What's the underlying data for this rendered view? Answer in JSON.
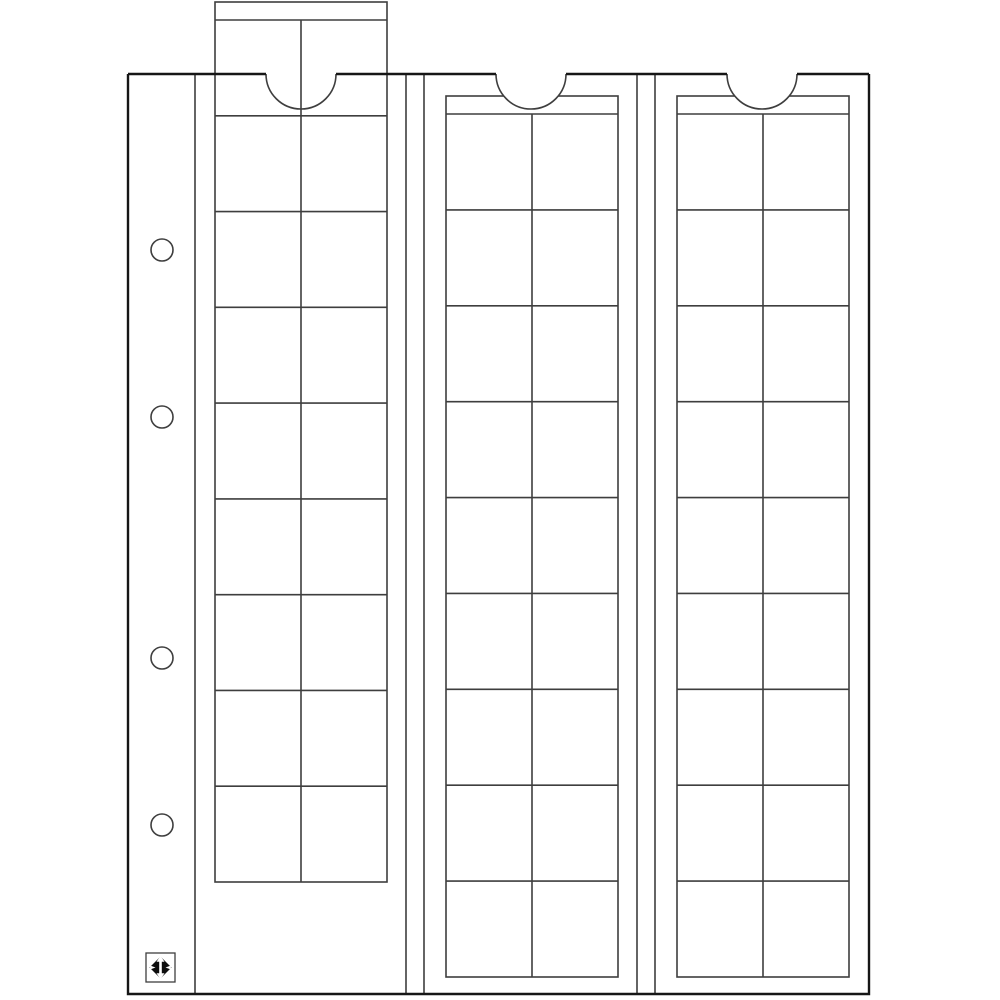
{
  "illustration": {
    "kind": "coin-album-pocket-sheet-line-drawing",
    "canvas": {
      "width": 1000,
      "height": 1000,
      "background": "#ffffff"
    },
    "style": {
      "fill": "#ffffff",
      "line_color": "#3e3e3e",
      "line_width": 1.6,
      "page_border_color": "#161616",
      "page_border_width": 2.4,
      "logo_black": "#0d0d0d",
      "logo_frame_width": 1.3
    },
    "page": {
      "left": 128,
      "top": 74,
      "right": 869,
      "bottom": 994
    },
    "binding_margin": {
      "divider_x": 195,
      "hole_count": 4,
      "holes": {
        "cx": 162,
        "r": 11,
        "cy_list": [
          250,
          417,
          658,
          825
        ]
      }
    },
    "slot_weld_lines_x": [
      406,
      424,
      637,
      655
    ],
    "thumb_notches": {
      "radius": 35,
      "centers_x": [
        301,
        531,
        762
      ]
    },
    "strips": [
      {
        "id": "strip-1",
        "left": 215,
        "top": 2,
        "right": 387,
        "bottom": 882,
        "header_line_y": 20,
        "center_x": 301,
        "rows": 9,
        "cols": 2,
        "pockets": 18,
        "pulled_out": true
      },
      {
        "id": "strip-2",
        "left": 446,
        "top": 96,
        "right": 618,
        "bottom": 977,
        "header_line_y": 114,
        "center_x": 532,
        "rows": 9,
        "cols": 2,
        "pockets": 18,
        "pulled_out": false
      },
      {
        "id": "strip-3",
        "left": 677,
        "top": 96,
        "right": 849,
        "bottom": 977,
        "header_line_y": 114,
        "center_x": 763,
        "rows": 9,
        "cols": 2,
        "pockets": 18,
        "pulled_out": false
      }
    ],
    "logo": {
      "x": 146,
      "y": 953,
      "size": 29
    }
  }
}
